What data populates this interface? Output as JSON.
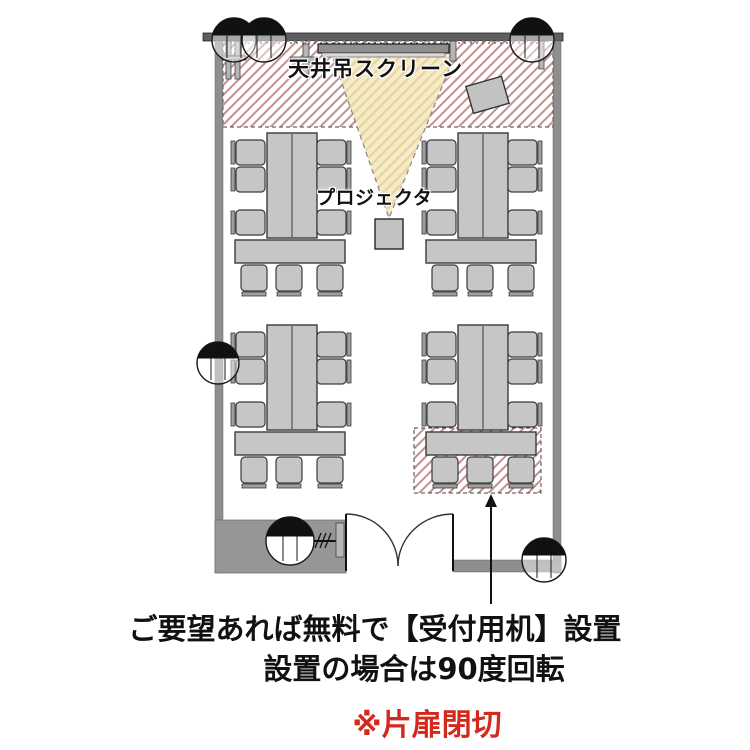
{
  "labels": {
    "screen": "天井吊スクリーン",
    "projector": "プロジェクタ"
  },
  "annotations": {
    "line1": "ご要望あれば無料で【受付用机】設置",
    "line2": "設置の場合は90度回転",
    "line3": "※片扉閉切"
  },
  "colors": {
    "annotation_text": "#111111",
    "annotation_red": "#d3281e",
    "hatch_line_red": "#c48f8f",
    "beam_fill": "#f5ebc8",
    "beam_hatch": "#e7d49c",
    "furniture_fill": "#c6c6c7",
    "furniture_edge": "#3a3a3a",
    "wall_gray": "#8e8e8e",
    "wall_dark": "#5f5f5f"
  },
  "symbols": {
    "ceiling_fixture": "circle-with-black-top-segment",
    "entrance": "double-swing-door",
    "projection_beam": "dashed-hatched-cone",
    "screen_hatch_zone": "diagonal-hatch-area",
    "reception_desk_hatch_zone": "diagonal-hatch-area",
    "pointer": "up-arrow"
  },
  "counts": {
    "table_groups": 4,
    "chairs_per_table_group": 9,
    "total_chairs": 36,
    "ceiling_fixtures": 6
  }
}
